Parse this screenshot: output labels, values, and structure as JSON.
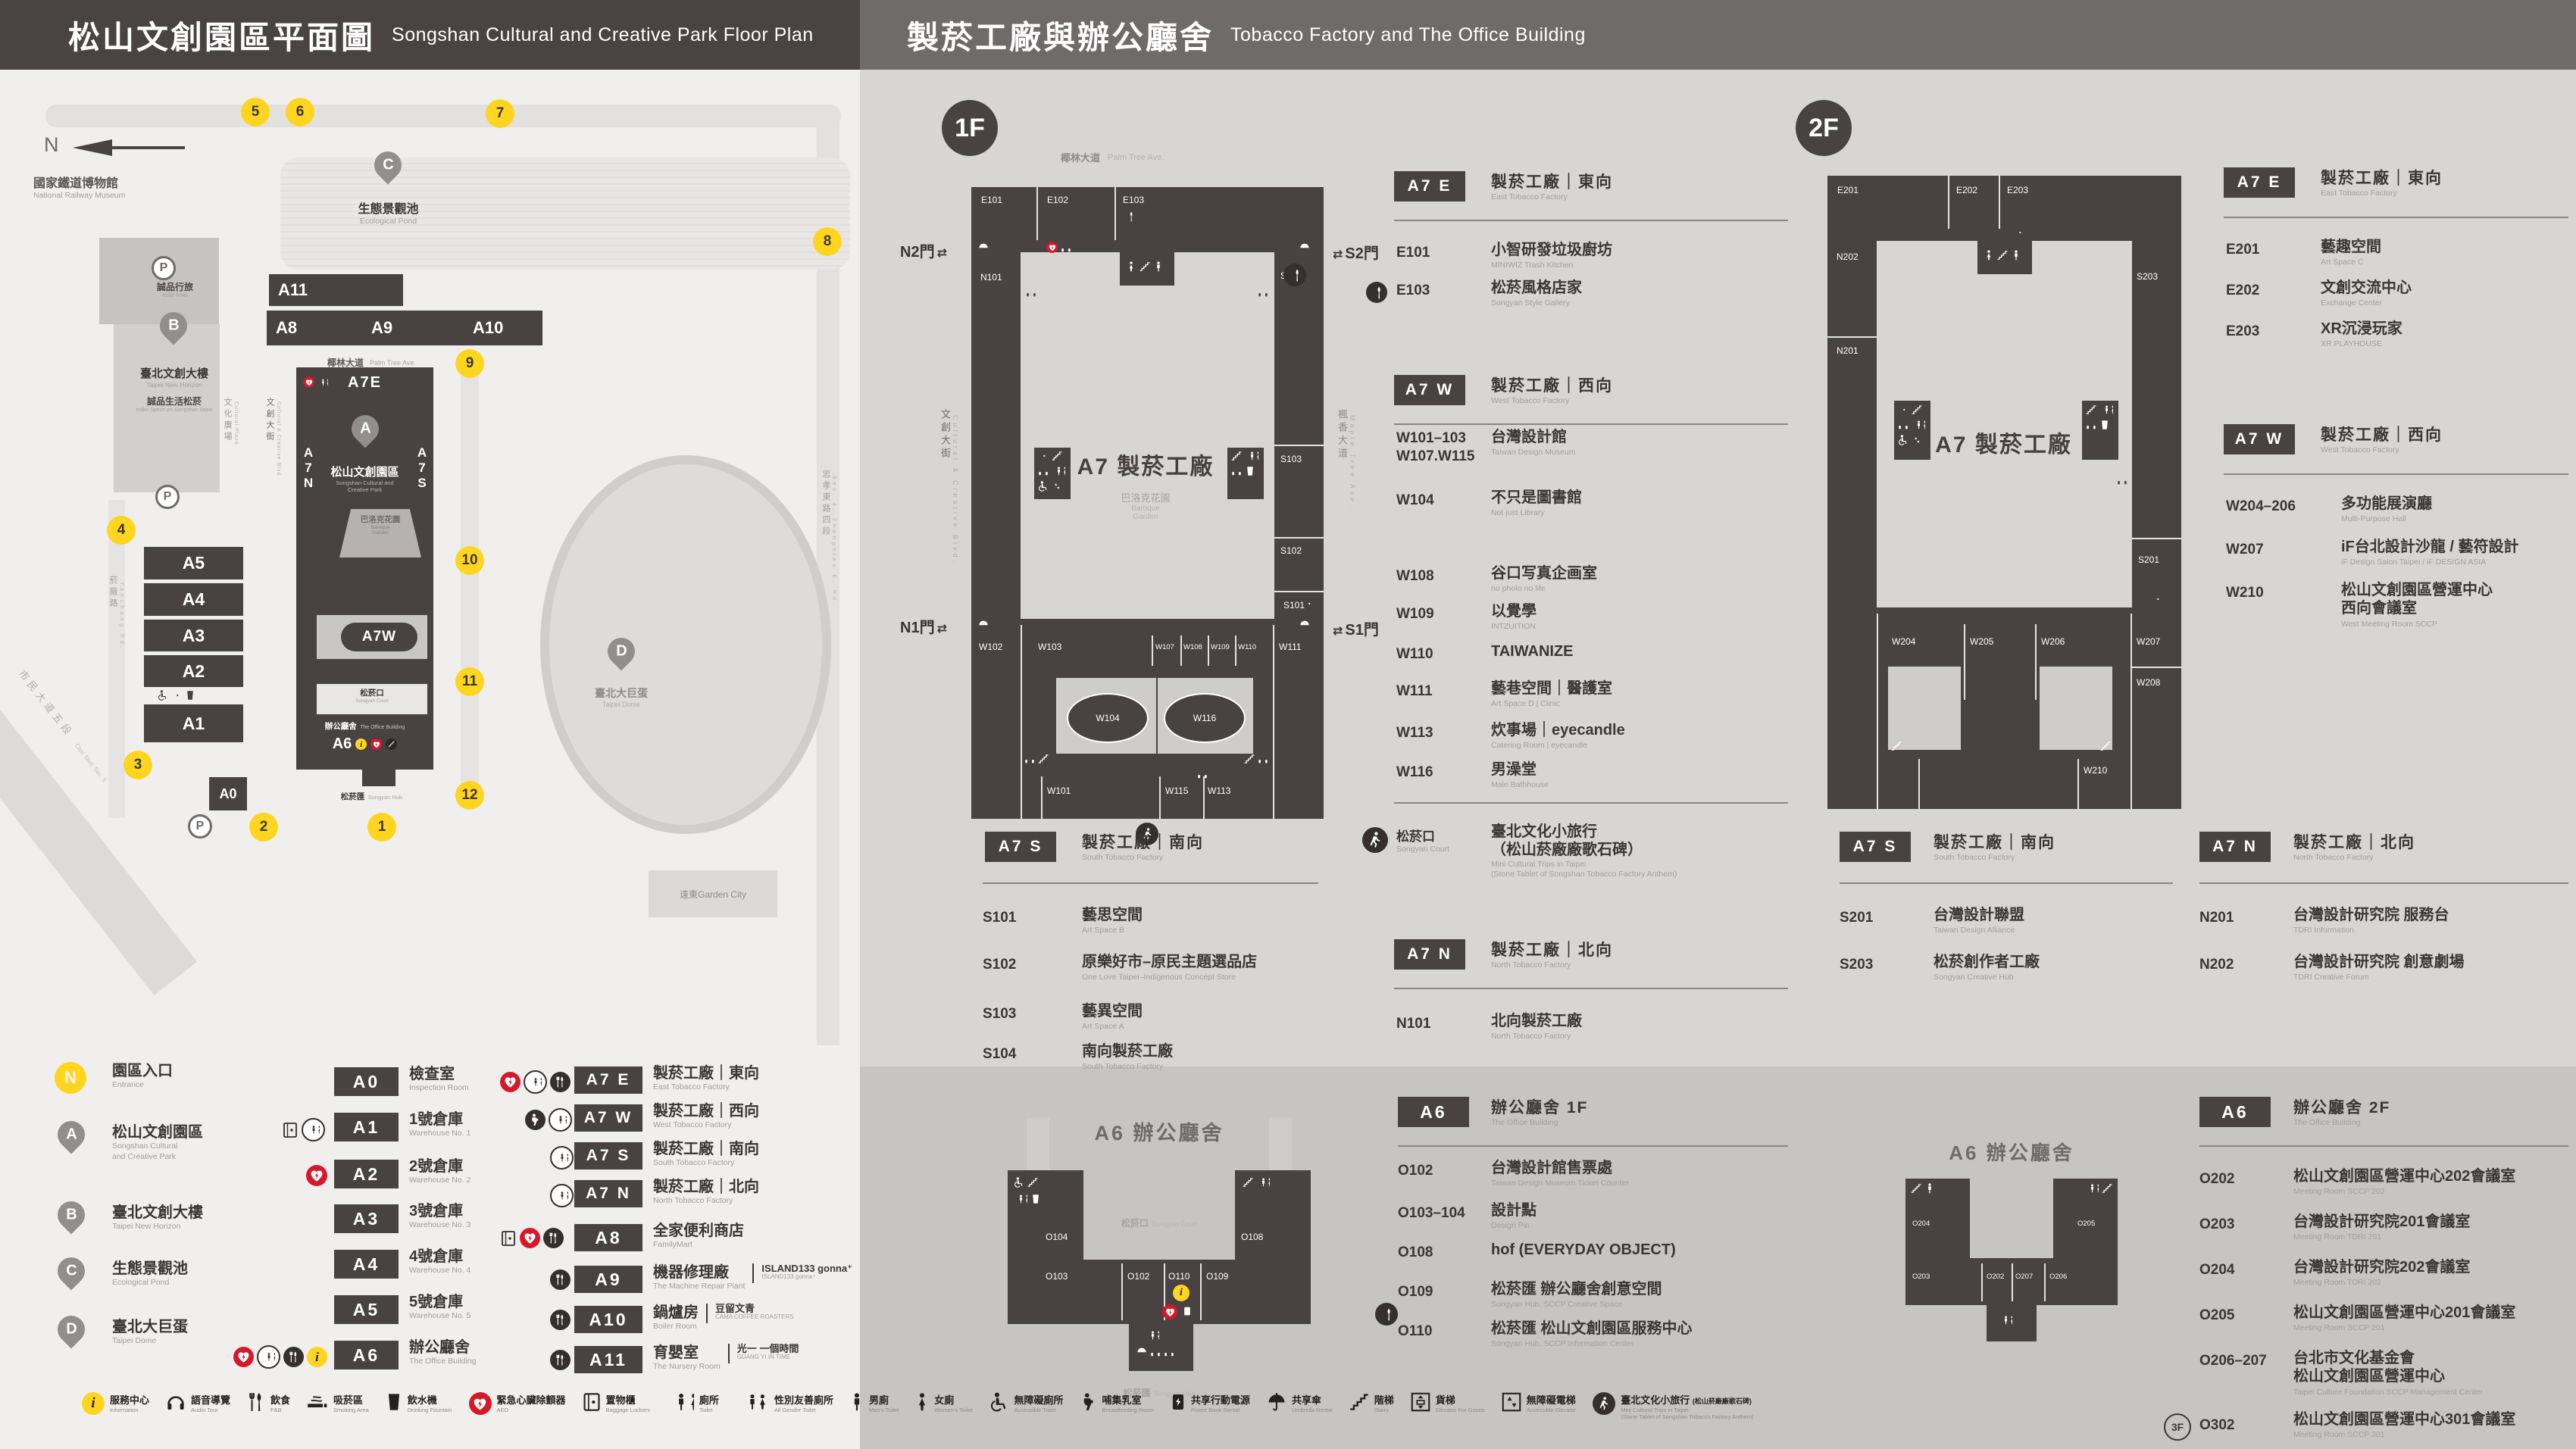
{
  "header": {
    "left_cn": "松山文創園區平面圖",
    "left_en": "Songshan Cultural and Creative Park Floor Plan",
    "right_cn": "製菸工廠與辦公廳舍",
    "right_en": "Tobacco Factory and The Office Building"
  },
  "map": {
    "compass": "N",
    "parking": "P",
    "landmarks": {
      "railway_cn": "國家鐵道博物館",
      "railway_en": "National Railway Museum",
      "hotel_cn": "誠品行旅",
      "hotel_en": "eslite hotel",
      "horizon_cn": "臺北文創大樓",
      "horizon_en": "Taipei New Horizon",
      "spectrum_cn": "誠品生活松菸",
      "spectrum_en": "eslite Spectrum Songshan Store",
      "pond_cn": "生態景觀池",
      "pond_en": "Ecological Pond",
      "park_cn": "松山文創園區",
      "park_en1": "Songshan Cultural and",
      "park_en2": "Creative Park",
      "garden_cn": "巴洛克花園",
      "garden_en1": "Baroque",
      "garden_en2": "Garden",
      "court_cn": "松菸口",
      "court_en": "Songyan Court",
      "office_cn": "辦公廳舍",
      "office_en": "The Office Building",
      "hub_cn": "松菸匯",
      "hub_en": "Songyan Hub",
      "dome_cn": "臺北大巨蛋",
      "dome_en": "Taipei Dome",
      "mall": "遠東Garden City"
    },
    "streets": {
      "palm_cn": "椰林大道",
      "palm_en": "Palm Tree Ave.",
      "plaza_cn": "文化廣場",
      "plaza_en": "Cultural Plaza",
      "cc_cn": "文創大街",
      "cc_en": "Cultural & Creative Blvd.",
      "yanchang_cn": "菸廠路",
      "yanchang_en": "Yanchang Rd.",
      "civic_cn": "市民大道五段",
      "civic_en": "Civic Blvd. Sec. 5",
      "zhongxiao_cn": "忠孝東路四段",
      "zhongxiao_en": "Sec. 4, Zhongxiao E. Rd."
    },
    "blocks": {
      "a11": "A11",
      "a8": "A8",
      "a9": "A9",
      "a10": "A10",
      "a5": "A5",
      "a4": "A4",
      "a3": "A3",
      "a2": "A2",
      "a1": "A1",
      "a0": "A0",
      "a6": "A6",
      "a7e": "A7E",
      "a7w": "A7W"
    },
    "a7n": [
      "A",
      "7",
      "N"
    ],
    "a7s": [
      "A",
      "7",
      "S"
    ],
    "pins": {
      "a": "A",
      "b": "B",
      "c": "C",
      "d": "D"
    },
    "entrances": [
      "1",
      "2",
      "3",
      "4",
      "5",
      "6",
      "7",
      "8",
      "9",
      "10",
      "11",
      "12"
    ]
  },
  "legend": {
    "places": [
      {
        "marker": "N",
        "cn": "園區入口",
        "en": "Entrance"
      },
      {
        "marker": "A",
        "cn": "松山文創園區",
        "en": "Songshan Cultural",
        "en2": "and Creative Park"
      },
      {
        "marker": "B",
        "cn": "臺北文創大樓",
        "en": "Taipei New Horizon"
      },
      {
        "marker": "C",
        "cn": "生態景觀池",
        "en": "Ecological Pond"
      },
      {
        "marker": "D",
        "cn": "臺北大巨蛋",
        "en": "Taipei Dome"
      }
    ],
    "col1": [
      {
        "code": "A0",
        "cn": "檢查室",
        "en": "Inspection Room"
      },
      {
        "code": "A1",
        "cn": "1號倉庫",
        "en": "Warehouse No. 1"
      },
      {
        "code": "A2",
        "cn": "2號倉庫",
        "en": "Warehouse No. 2"
      },
      {
        "code": "A3",
        "cn": "3號倉庫",
        "en": "Warehouse No. 3"
      },
      {
        "code": "A4",
        "cn": "4號倉庫",
        "en": "Warehouse No. 4"
      },
      {
        "code": "A5",
        "cn": "5號倉庫",
        "en": "Warehouse No. 5"
      },
      {
        "code": "A6",
        "cn": "辦公廳舍",
        "en": "The Office Building"
      }
    ],
    "col2": [
      {
        "code": "A7 E",
        "cn": "製菸工廠｜東向",
        "en": "East Tobacco Factory"
      },
      {
        "code": "A7 W",
        "cn": "製菸工廠｜西向",
        "en": "West Tobacco Factory"
      },
      {
        "code": "A7 S",
        "cn": "製菸工廠｜南向",
        "en": "South Tobacco Factory"
      },
      {
        "code": "A7 N",
        "cn": "製菸工廠｜北向",
        "en": "North Tobacco Factory"
      },
      {
        "code": "A8",
        "cn": "全家便利商店",
        "en": "FamilyMart"
      },
      {
        "code": "A9",
        "cn": "機器修理廠",
        "en": "The Machine Repair Plant",
        "brand": "ISLAND133 gonna⁺",
        "brand_sub": "ISLAND133 gonna⁺"
      },
      {
        "code": "A10",
        "cn": "鍋爐房",
        "en": "Boiler Room",
        "brand": "豆留文青",
        "brand_sub": "CAMA COFFEE ROASTERS"
      },
      {
        "code": "A11",
        "cn": "育嬰室",
        "en": "The Nursery Room",
        "brand": "光一 一個時間",
        "brand_sub": "GUANG YI IN TIME"
      }
    ]
  },
  "facilities": [
    {
      "cn": "服務中心",
      "en": "Information"
    },
    {
      "cn": "語音導覽",
      "en": "Audio Tour"
    },
    {
      "cn": "飲食",
      "en": "F&B"
    },
    {
      "cn": "吸菸區",
      "en": "Smoking Area"
    },
    {
      "cn": "飲水機",
      "en": "Drinking Fountain"
    },
    {
      "cn": "緊急心臟除顫器",
      "en": "AED"
    },
    {
      "cn": "置物櫃",
      "en": "Baggage Lockers"
    },
    {
      "cn": "廁所",
      "en": "Toilet"
    },
    {
      "cn": "性別友善廁所",
      "en": "All Gender Toilet"
    },
    {
      "cn": "男廁",
      "en": "Men's Toilet"
    },
    {
      "cn": "女廁",
      "en": "Women's Toilet"
    },
    {
      "cn": "無障礙廁所",
      "en": "Accessible Toilet"
    },
    {
      "cn": "哺集乳室",
      "en": "Breastfeeding Room"
    },
    {
      "cn": "共享行動電源",
      "en": "Power Bank Rental"
    },
    {
      "cn": "共享傘",
      "en": "Umbrella Rental"
    },
    {
      "cn": "階梯",
      "en": "Stairs"
    },
    {
      "cn": "貨梯",
      "en": "Elevator For Goods"
    },
    {
      "cn": "無障礙電梯",
      "en": "Accessible Elevator"
    },
    {
      "cn": "臺北文化小旅行",
      "cn2": "(松山菸廠廠歌石碑)",
      "en": "Mini Cultural Trips in Taipei",
      "en2": "(Stone Tablet of Songshan Tobacco Factory Anthem)"
    }
  ],
  "f1": {
    "badge": "1F",
    "plan": {
      "label": "A7 製菸工廠",
      "rooms": {
        "e101": "E101",
        "e102": "E102",
        "e103": "E103",
        "n101": "N101",
        "s101": "S101",
        "s102": "S102",
        "s103": "S103",
        "s104": "S104",
        "w101": "W101",
        "w102": "W102",
        "w103": "W103",
        "w104": "W104",
        "w107": "W107",
        "w108": "W108",
        "w109": "W109",
        "w110": "W110",
        "w111": "W111",
        "w113": "W113",
        "w115": "W115",
        "w116": "W116"
      },
      "gates": {
        "n2": "N2門",
        "s2": "S2門",
        "n1": "N1門",
        "s1": "S1門"
      },
      "streets": {
        "palm_cn": "椰林大道",
        "palm_en": "Palm Tree Ave.",
        "cc_cn": "文創大街",
        "cc_en": "Cultural & Creative Blvd.",
        "maple_cn": "楓香大道",
        "maple_en": "Maple Tree Ave."
      },
      "garden_cn": "巴洛克花園",
      "garden_en1": "Baroque",
      "garden_en2": "Garden"
    },
    "a7e": {
      "badge": "A7 E",
      "cn": "製菸工廠｜東向",
      "en": "East Tobacco Factory",
      "rooms": [
        {
          "code": "E101",
          "cn": "小智研發垃圾廚坊",
          "en": "MINIWIZ Trash Kitchen"
        },
        {
          "code": "E103",
          "cn": "松菸風格店家",
          "en": "Songyan Style Gallery"
        }
      ]
    },
    "a7w": {
      "badge": "A7 W",
      "cn": "製菸工廠｜西向",
      "en": "West Tobacco Factory",
      "rooms": [
        {
          "code": "W101–103",
          "code2": "W107.W115",
          "cn": "台灣設計館",
          "en": "Taiwan Design Museum"
        },
        {
          "code": "W104",
          "cn": "不只是圖書館",
          "en": "Not just Library"
        },
        {
          "code": "W108",
          "cn": "谷口写真企画室",
          "en": "no photo no life"
        },
        {
          "code": "W109",
          "cn": "以覺學",
          "en": "INTZUITION"
        },
        {
          "code": "W110",
          "cn": "TAIWANIZE",
          "en": ""
        },
        {
          "code": "W111",
          "cn": "藝巷空間｜醫護室",
          "en": "Art Space D | Clinic"
        },
        {
          "code": "W113",
          "cn": "炊事場｜eyecandle",
          "en": "Catering Room | eyecandle"
        },
        {
          "code": "W116",
          "cn": "男澡堂",
          "en": "Male Bathhouse"
        }
      ]
    },
    "a7s": {
      "badge": "A7 S",
      "cn": "製菸工廠｜南向",
      "en": "South Tobacco Factory",
      "rooms": [
        {
          "code": "S101",
          "cn": "藝思空間",
          "en": "Art Space B"
        },
        {
          "code": "S102",
          "cn": "原樂好市–原民主題選品店",
          "en": "One Love Taipei–Indigenous Concept Store"
        },
        {
          "code": "S103",
          "cn": "藝異空間",
          "en": "Art Space A"
        },
        {
          "code": "S104",
          "cn": "南向製菸工廠",
          "en": "South Tobacco Factory"
        }
      ]
    },
    "court": {
      "cn": "松菸口",
      "en": "Songyan Court",
      "line1": "臺北文化小旅行",
      "line2": "（松山菸廠廠歌石碑）",
      "en1": "Mini Cultural Trips in Taipei",
      "en2": "(Stone Tablet of Songshan Tobacco Factory Anthem)"
    },
    "a7n": {
      "badge": "A7 N",
      "cn": "製菸工廠｜北向",
      "en": "North Tobacco Factory",
      "rooms": [
        {
          "code": "N101",
          "cn": "北向製菸工廠",
          "en": "North Tobacco Factory"
        }
      ]
    }
  },
  "f2": {
    "badge": "2F",
    "plan": {
      "label": "A7 製菸工廠",
      "rooms": {
        "e201": "E201",
        "e202": "E202",
        "e203": "E203",
        "n201": "N201",
        "n202": "N202",
        "s201": "S201",
        "s203": "S203",
        "w204": "W204",
        "w205": "W205",
        "w206": "W206",
        "w207": "W207",
        "w208": "W208",
        "w210": "W210"
      }
    },
    "a7e": {
      "badge": "A7 E",
      "cn": "製菸工廠｜東向",
      "en": "East Tobacco Factory",
      "rooms": [
        {
          "code": "E201",
          "cn": "藝趣空間",
          "en": "Art Space C"
        },
        {
          "code": "E202",
          "cn": "文創交流中心",
          "en": "Exchange Center"
        },
        {
          "code": "E203",
          "cn": "XR沉浸玩家",
          "en": "XR PLAYHOUSE"
        }
      ]
    },
    "a7w": {
      "badge": "A7 W",
      "cn": "製菸工廠｜西向",
      "en": "West Tobacco Factory",
      "rooms": [
        {
          "code": "W204–206",
          "cn": "多功能展演廳",
          "en": "Multi-Purpose Hall"
        },
        {
          "code": "W207",
          "cn": "iF台北設計沙龍 / 藝符設計",
          "en": "iF Design Salon Taipei / iF DESIGN ASIA"
        },
        {
          "code": "W210",
          "cn": "松山文創園區營運中心",
          "cn2": "西向會議室",
          "en": "West Meeting Room SCCP"
        }
      ]
    },
    "a7s": {
      "badge": "A7 S",
      "cn": "製菸工廠｜南向",
      "en": "South Tobacco Factory",
      "rooms": [
        {
          "code": "S201",
          "cn": "台灣設計聯盟",
          "en": "Taiwan Design Alliance"
        },
        {
          "code": "S203",
          "cn": "松菸創作者工廠",
          "en": "Songyan Creative Hub"
        }
      ]
    },
    "a7n": {
      "badge": "A7 N",
      "cn": "製菸工廠｜北向",
      "en": "North Tobacco Factory",
      "rooms": [
        {
          "code": "N201",
          "cn": "台灣設計研究院 服務台",
          "en": "TDRI Information"
        },
        {
          "code": "N202",
          "cn": "台灣設計研究院 創意劇場",
          "en": "TDRI Creative Forum"
        }
      ]
    }
  },
  "o1": {
    "plan_title": "A6 辦公廳舍",
    "badge": "A6",
    "cn": "辦公廳舍 1F",
    "en": "The Office Building",
    "court_cn": "松菸口",
    "court_en": "Songyan Court",
    "hub_cn": "松菸匯",
    "hub_en": "Songyan Hub",
    "plan_rooms": {
      "o102": "O102",
      "o103": "O103",
      "o104": "O104",
      "o108": "O108",
      "o109": "O109",
      "o110": "O110"
    },
    "rooms": [
      {
        "code": "O102",
        "cn": "台灣設計館售票處",
        "en": "Taiwan Design Museum Ticket Counter"
      },
      {
        "code": "O103–104",
        "cn": "設計點",
        "en": "Design Pin"
      },
      {
        "code": "O108",
        "cn": "hof (EVERYDAY OBJECT)",
        "en": ""
      },
      {
        "code": "O109",
        "cn": "松菸匯 辦公廳舍創意空間",
        "en": "Songyan Hub, SCCP Creative Space"
      },
      {
        "code": "O110",
        "cn": "松菸匯 松山文創園區服務中心",
        "en": "Songyan Hub, SCCP Information Center"
      }
    ]
  },
  "o2": {
    "plan_title": "A6 辦公廳舍",
    "badge": "A6",
    "cn": "辦公廳舍 2F",
    "en": "The Office Building",
    "plan_rooms": {
      "o202": "O202",
      "o203": "O203",
      "o204": "O204",
      "o205": "O205",
      "o206": "O206",
      "o207": "O207"
    },
    "rooms": [
      {
        "code": "O202",
        "cn": "松山文創園區營運中心202會議室",
        "en": "Meeting Room SCCP 202"
      },
      {
        "code": "O203",
        "cn": "台灣設計研究院201會議室",
        "en": "Meeting Room TDRI 201"
      },
      {
        "code": "O204",
        "cn": "台灣設計研究院202會議室",
        "en": "Meeting Room TDRI 202"
      },
      {
        "code": "O205",
        "cn": "松山文創園區營運中心201會議室",
        "en": "Meeting Room SCCP 201"
      },
      {
        "code": "O206–207",
        "cn": "台北市文化基金會",
        "cn2": "松山文創園區營運中心",
        "en": "Taipei Culture Foundation SCCP Management Center"
      },
      {
        "prefix": "3F",
        "code": "O302",
        "cn": "松山文創園區營運中心301會議室",
        "en": "Meeting Room SCCP 301"
      }
    ]
  }
}
